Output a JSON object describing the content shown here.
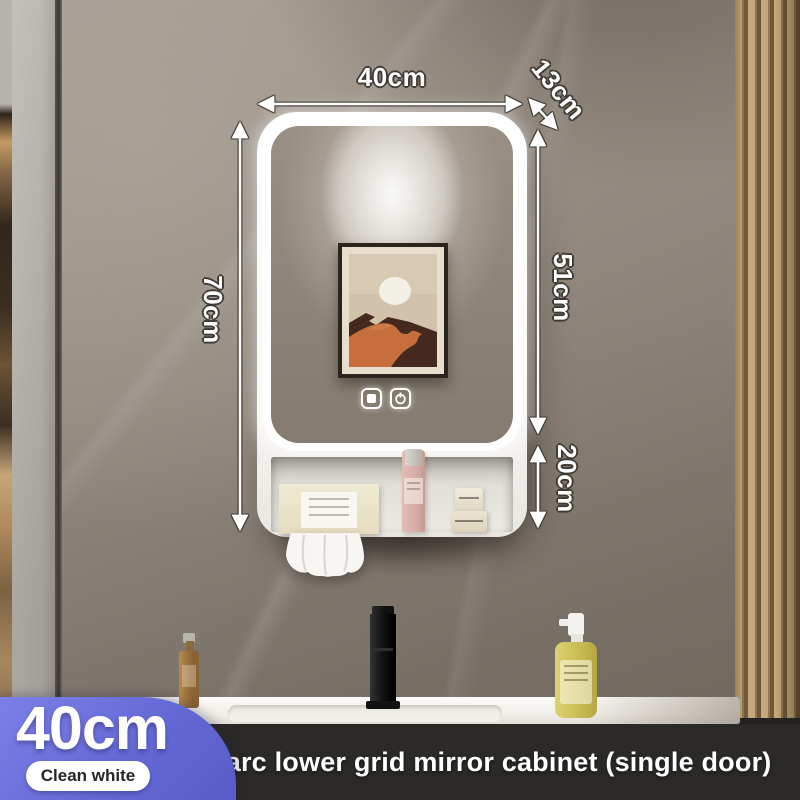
{
  "product": {
    "dimensions": {
      "width": "40cm",
      "depth": "13cm",
      "height": "70cm",
      "mirror_section_height": "51cm",
      "shelf_section_height": "20cm"
    },
    "badge": {
      "size": "40cm",
      "finish": "Clean white"
    },
    "caption": "Smart arc lower grid mirror cabinet (single door)",
    "colors": {
      "badge_accent": "#6b70dc",
      "caption_bar": "#2d2b28",
      "led_glow": "#ffffff"
    },
    "mirror_controls": [
      {
        "icon": "defog-icon"
      },
      {
        "icon": "power-icon"
      }
    ]
  }
}
